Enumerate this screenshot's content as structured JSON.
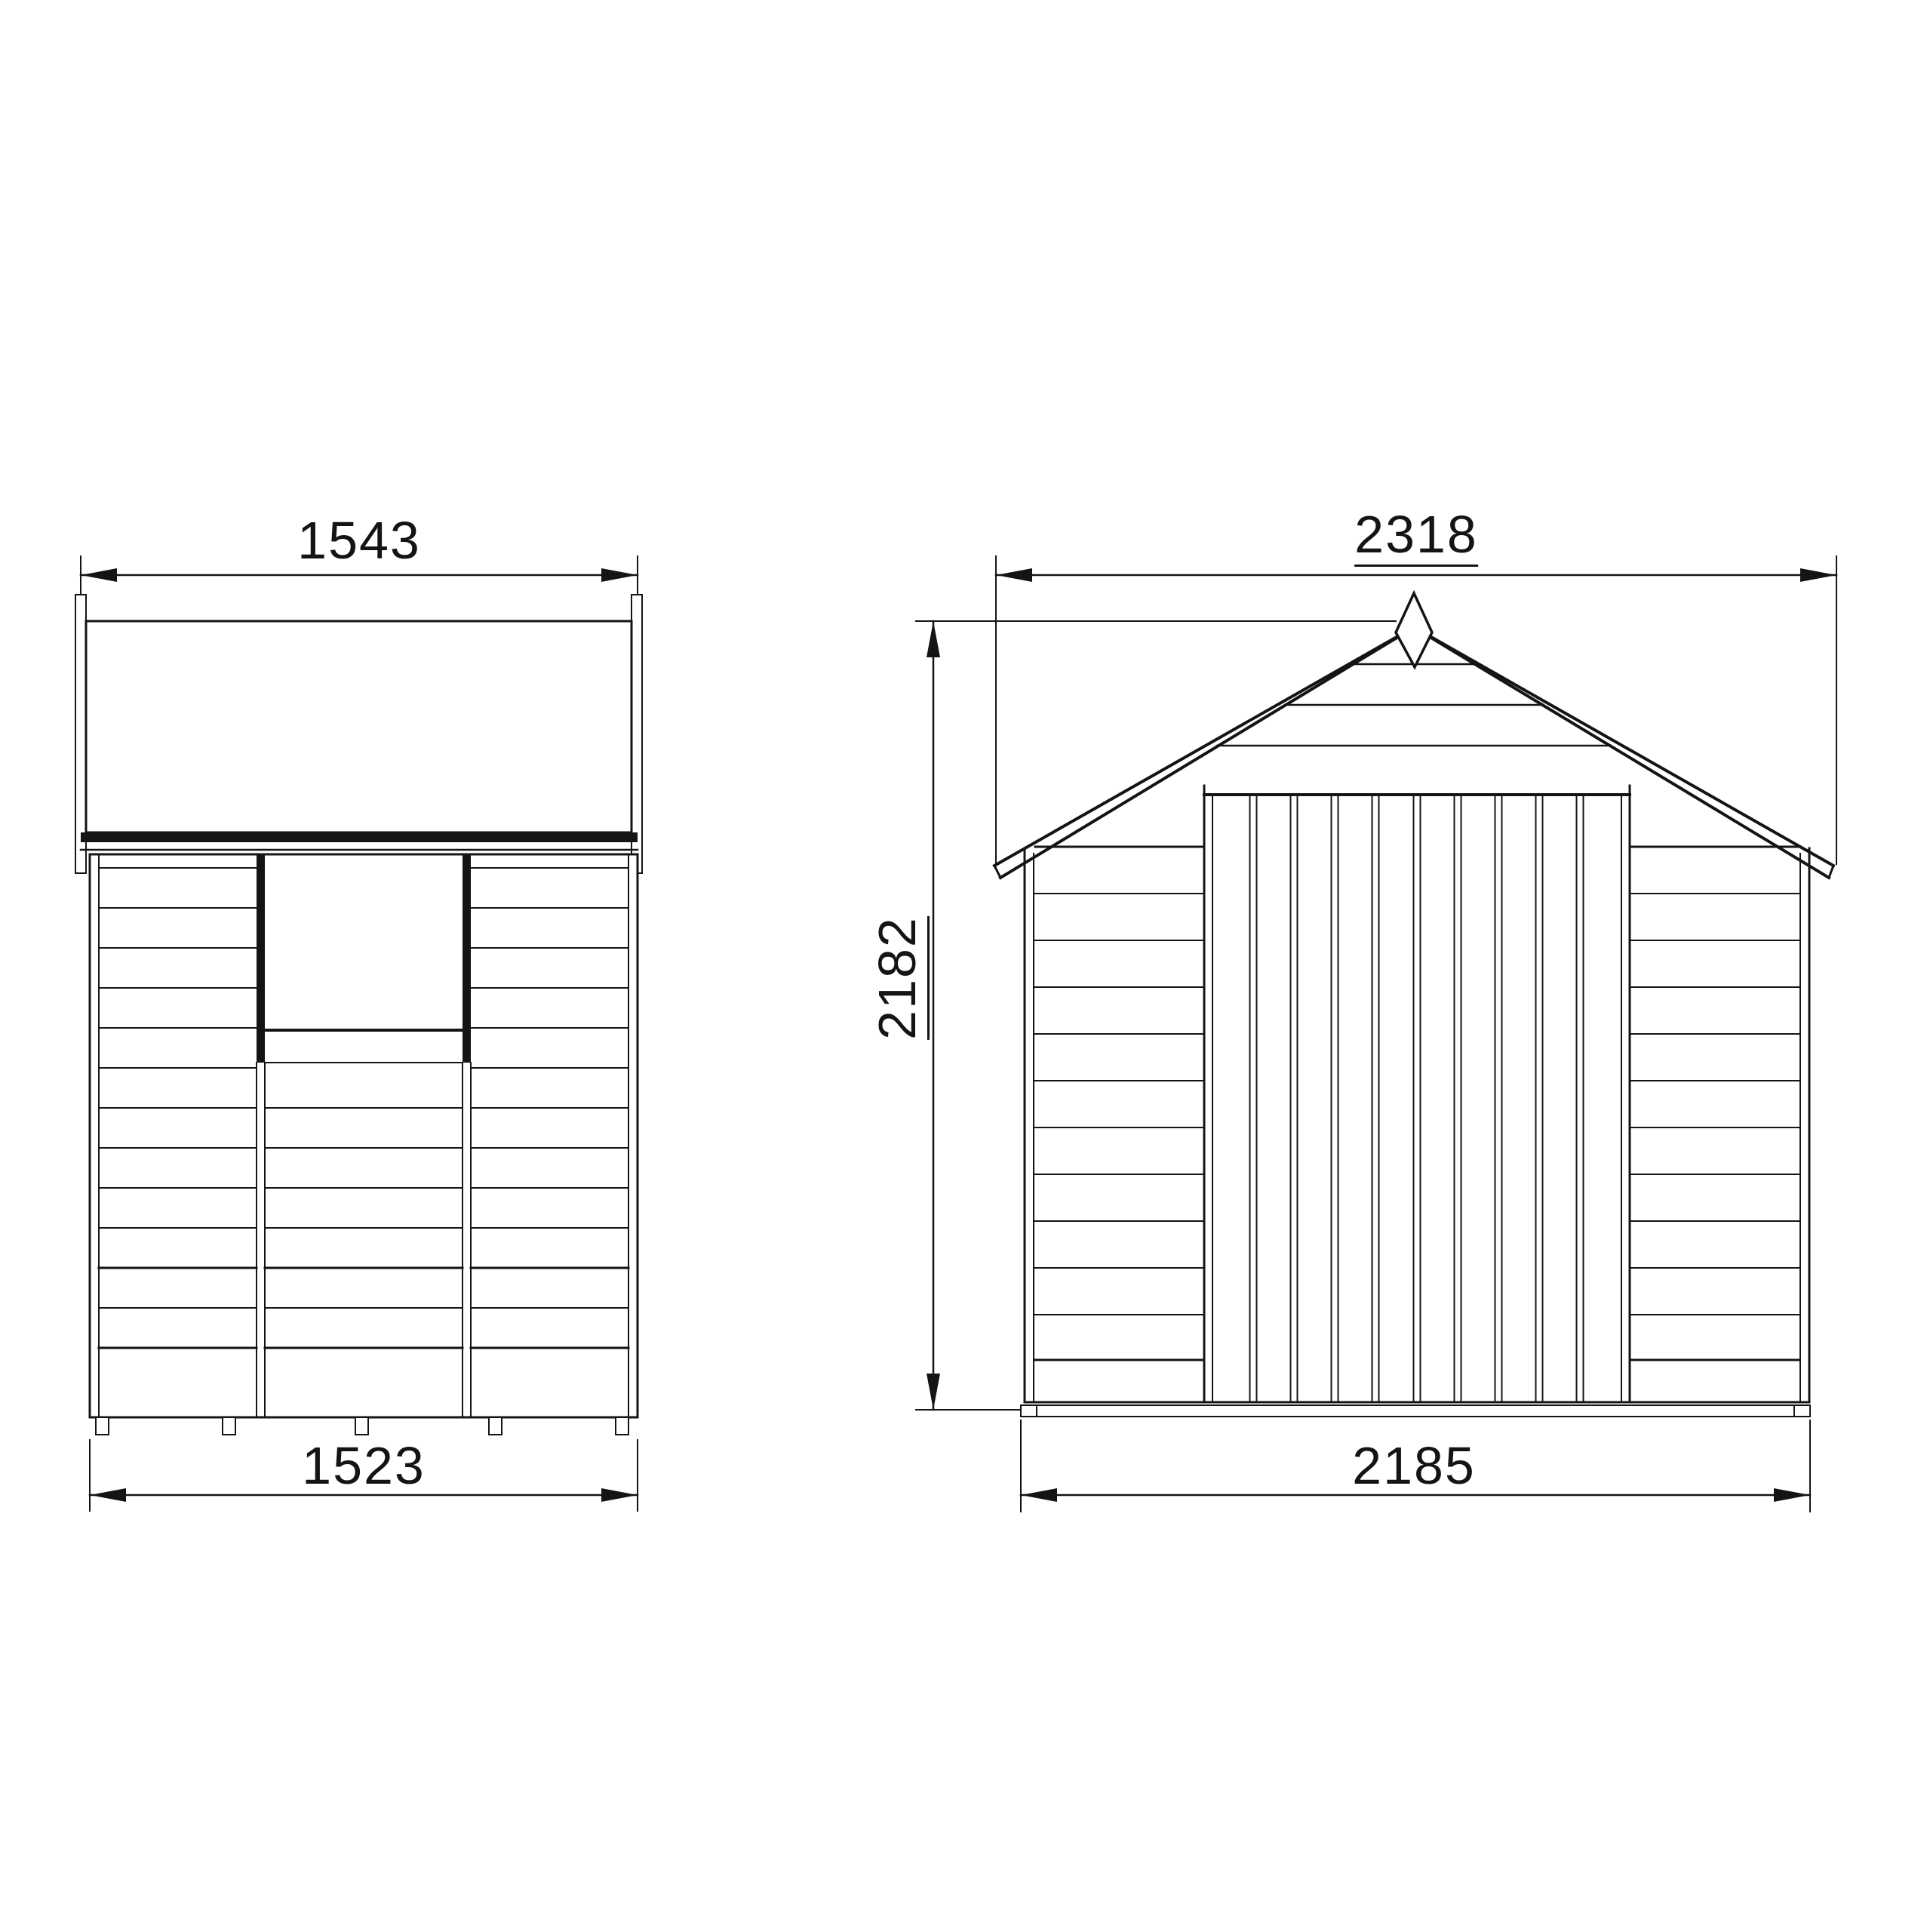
{
  "drawing": {
    "type": "shed-dimension-diagram",
    "background": "#ffffff",
    "ink_color": "#141414",
    "views": {
      "side": {
        "name": "side-elevation",
        "dim_top": {
          "value": "1543",
          "underlined": false
        },
        "dim_bottom": {
          "value": "1523",
          "underlined": false
        }
      },
      "front": {
        "name": "front-elevation",
        "dim_top": {
          "value": "2318",
          "underlined": true
        },
        "dim_height": {
          "value": "2182",
          "underlined": true
        },
        "dim_bottom": {
          "value": "2185",
          "underlined": false
        }
      }
    }
  }
}
